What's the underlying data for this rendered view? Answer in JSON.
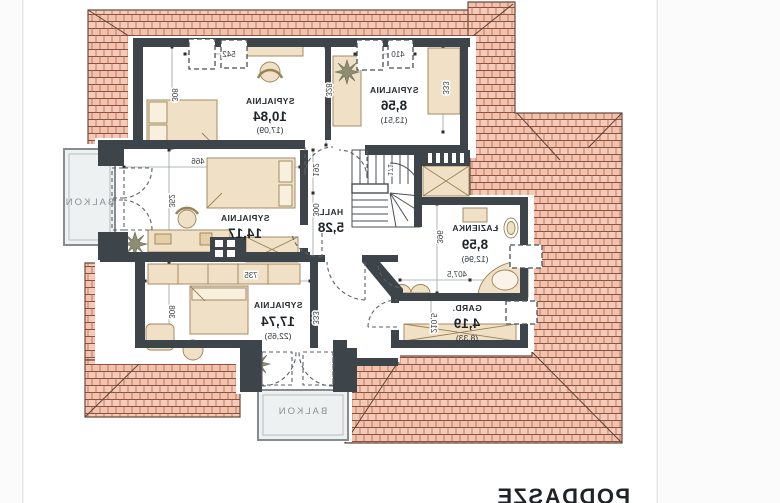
{
  "page": {
    "title": "PODDASZE"
  },
  "rooms": {
    "sypialnia_top_left": {
      "name": "SYPIALNIA",
      "area": "10,84",
      "area_gross": "(17,09)"
    },
    "sypialnia_top_right": {
      "name": "SYPIALNIA",
      "area": "8,56",
      "area_gross": "(13,51)"
    },
    "sypialnia_middle": {
      "name": "SYPIALNIA",
      "area": "14,17"
    },
    "hall": {
      "name": "HALL",
      "area": "5,28"
    },
    "lazienka": {
      "name": "ŁAZIENKA",
      "area": "8,59",
      "area_gross": "(12,96)"
    },
    "garderoba": {
      "name": "GARD.",
      "area": "4,19",
      "area_gross": "(8,33)"
    },
    "sypialnia_bottom": {
      "name": "SYPIALNIA",
      "area": "17,74",
      "area_gross": "(22,65)"
    },
    "balkon_left": {
      "name": "BALKON"
    },
    "balkon_bottom": {
      "name": "BALKON"
    }
  },
  "dimensions": {
    "s1_side": "308",
    "skylight_left_width": "542",
    "s1_right_side": "328",
    "skylight_right_width": "410",
    "s2_side": "333",
    "s3_width": "466",
    "s3_side": "352",
    "hall_upper": "192",
    "hall_lower": "300",
    "stairs_width": "171",
    "bathroom_depth": "396",
    "bathroom_width": "407,5",
    "gard_depth": "210,5",
    "s4_width": "735",
    "s4_side": "308",
    "s4_right_side": "333"
  },
  "palette": {
    "roof_tile": "#f5cab7",
    "roof_line": "#9a5a46",
    "roof_edge": "#6b4a3c",
    "wall": "#3d444a",
    "furniture_fill": "#f0e1c6",
    "furniture_line": "#9b8257",
    "balcony_fill": "#eef1f1",
    "dim_line": "#9aa0a2",
    "text": "#262b30"
  }
}
